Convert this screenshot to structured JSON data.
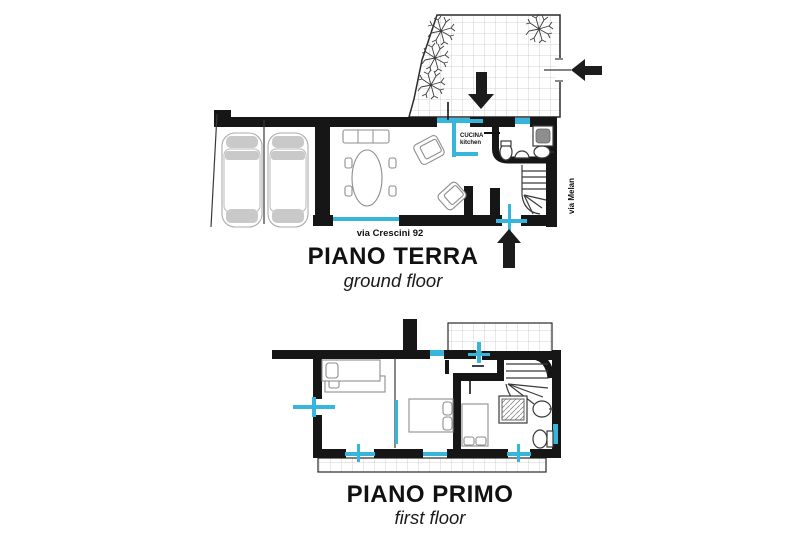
{
  "colors": {
    "paper": "#ffffff",
    "wall": "#161616",
    "line": "#3a3a3a",
    "window": "#36b6dd",
    "furniture": "#8e8e8e",
    "furniture-light": "#c9c9c9",
    "grid": "#c6c6c6"
  },
  "ground_floor": {
    "title": "PIANO TERRA",
    "subtitle": "ground floor",
    "street_front": "via Crescini 92",
    "street_side": "via Melan",
    "kitchen_label_primary": "CUCINA",
    "kitchen_label_secondary": "kitchen"
  },
  "first_floor": {
    "title": "PIANO PRIMO",
    "subtitle": "first floor"
  }
}
